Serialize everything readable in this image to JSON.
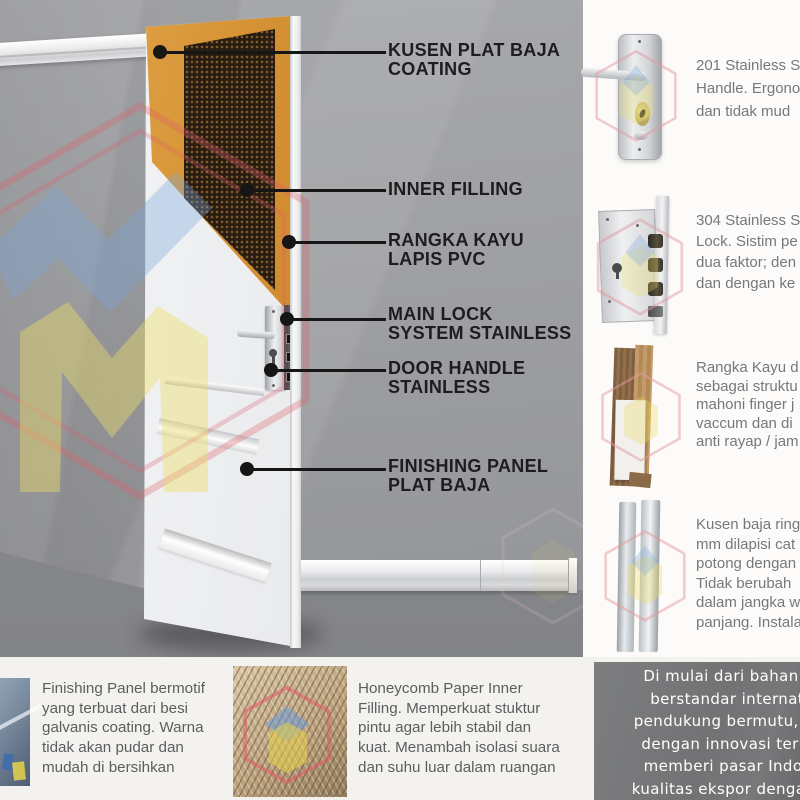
{
  "callouts": [
    {
      "line1": "KUSEN PLAT BAJA",
      "line2": "COATING"
    },
    {
      "line1": "INNER FILLING",
      "line2": ""
    },
    {
      "line1": "RANGKA KAYU",
      "line2": "LAPIS PVC"
    },
    {
      "line1": "MAIN LOCK",
      "line2": "SYSTEM STAINLESS"
    },
    {
      "line1": "DOOR HANDLE",
      "line2": "STAINLESS"
    },
    {
      "line1": "FINISHING PANEL",
      "line2": "PLAT BAJA"
    }
  ],
  "features": [
    {
      "icon": "stainless-handle",
      "lines": [
        "201 Stainless St",
        "Handle. Ergono",
        "dan tidak mud"
      ]
    },
    {
      "icon": "stainless-lock",
      "lines": [
        "304 Stainless St",
        "Lock. Sistim pe",
        "dua faktor; den",
        "dan dengan ke"
      ]
    },
    {
      "icon": "wood-frame",
      "lines": [
        "Rangka Kayu d",
        "sebagai struktu",
        "mahoni finger j",
        "vaccum dan di",
        "anti rayap / jam"
      ]
    },
    {
      "icon": "steel-frame",
      "lines": [
        "Kusen baja ring",
        "mm dilapisi cat",
        "potong dengan",
        "Tidak berubah",
        "dalam jangka w",
        "panjang. Instala"
      ]
    }
  ],
  "bottom_left": {
    "lines": [
      "Finishing Panel bermotif",
      "yang terbuat dari besi",
      "galvanis coating. Warna",
      "tidak akan pudar dan",
      "mudah di bersihkan"
    ]
  },
  "bottom_middle": {
    "lines": [
      "Honeycomb Paper Inner",
      "Filling. Memperkuat stuktur",
      "pintu agar lebih stabil dan",
      "kuat. Menambah isolasi suara",
      "dan suhu luar dalam ruangan"
    ]
  },
  "bottom_right": {
    "lines": [
      "Di mulai dari bahan utam",
      "berstandar internationa",
      "pendukung bermutu, metod",
      "dengan innovasi terkini; k",
      "memberi pasar Indonesia",
      "kualitas ekspor dengan harg"
    ]
  },
  "colors": {
    "wall_gray": "#9c9da0",
    "wood_orange": "#d28e30",
    "honeycomb_dark": "#281c11",
    "panel_dark": "#6e6f71",
    "logo_pink": "#dd5f6b",
    "logo_yellow": "#eedd66",
    "logo_blue": "#7aa6dd",
    "callout_text": "#1d1d1f",
    "body_text": "#77787b",
    "panel_text": "#ffffff"
  }
}
